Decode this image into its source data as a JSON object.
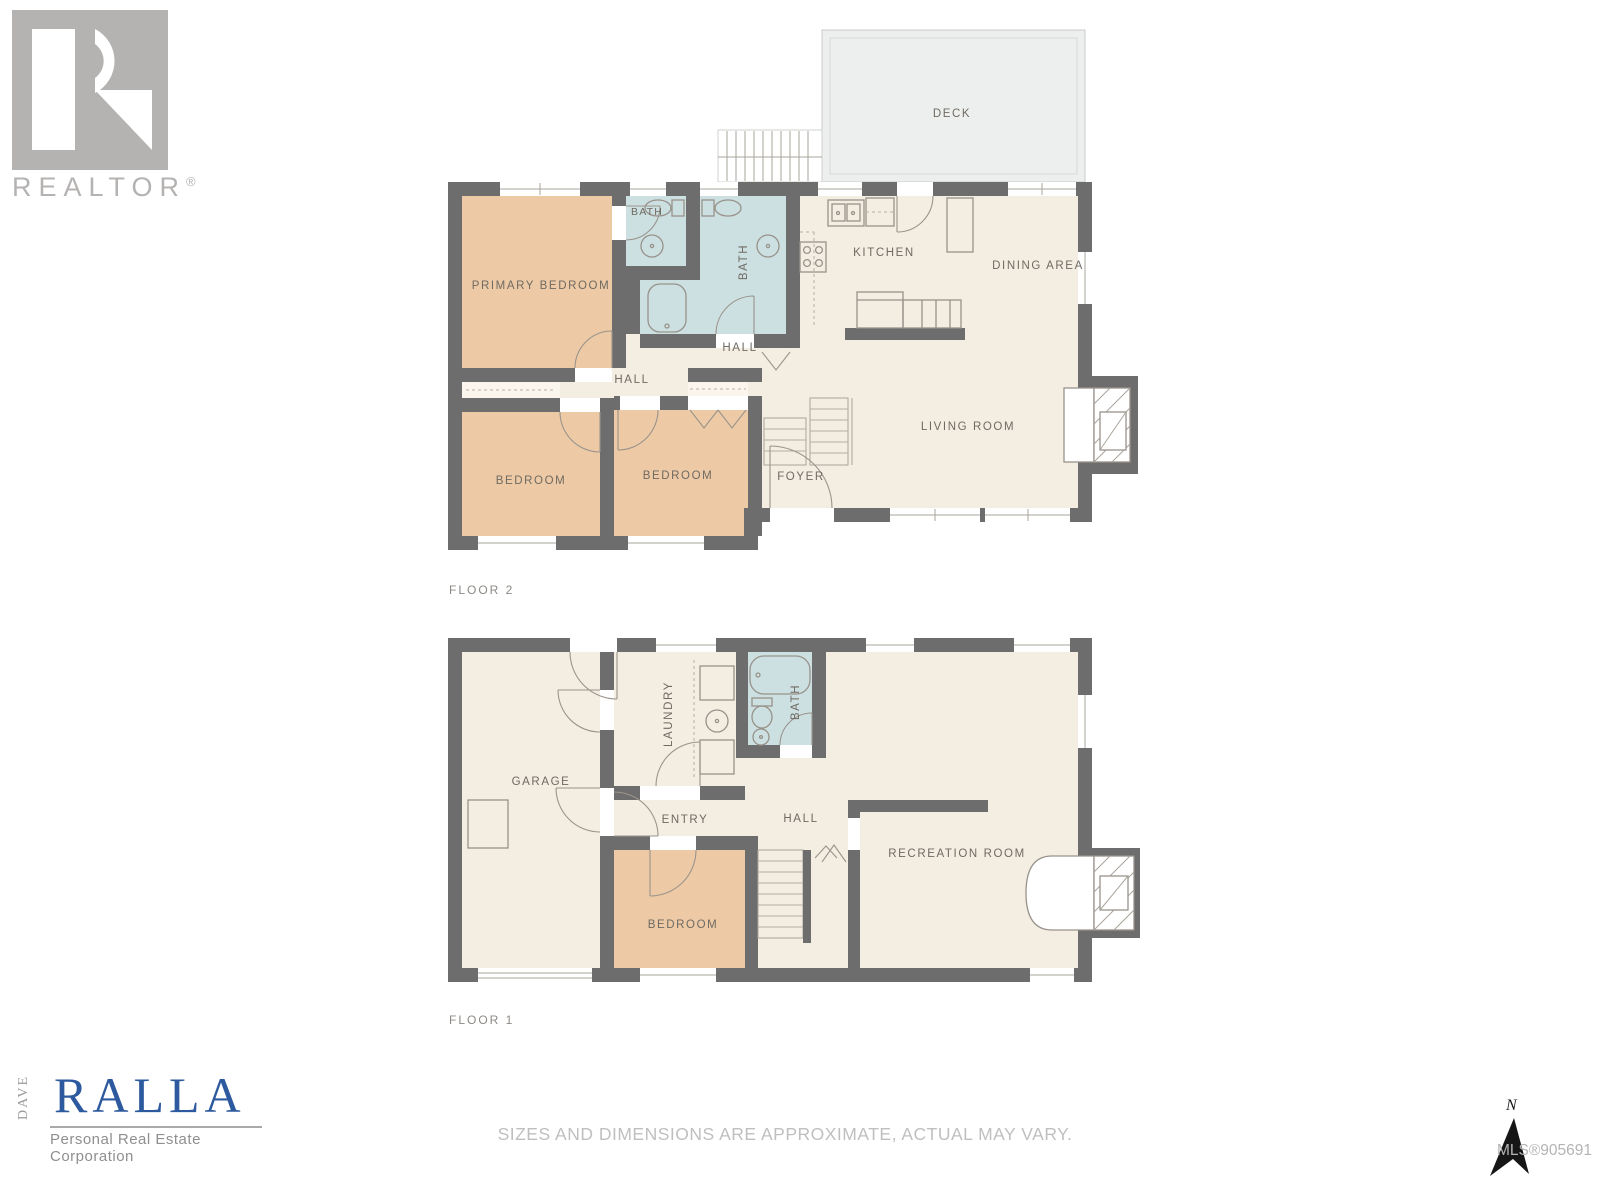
{
  "branding": {
    "realtor_wordmark": "REALTOR",
    "registered_symbol": "®",
    "agent": {
      "first_name": "DAVE",
      "last_name": "RALLA",
      "tagline": "Personal Real Estate Corporation"
    }
  },
  "colors": {
    "wall": "#6e6d6d",
    "floor": "#f4ede2",
    "bedroom_fill": "#edcaa5",
    "bath_fill": "#cde0e1",
    "deck_fill": "#edefef",
    "brand_blue": "#2d5a9e",
    "logo_gray": "#b5b3b2"
  },
  "floor2": {
    "label": "FLOOR 2",
    "deck": "DECK",
    "primary_bedroom": "PRIMARY BEDROOM",
    "bath_ensuite": "BATH",
    "bath_main": "BATH",
    "kitchen": "KITCHEN",
    "dining_area": "DINING AREA",
    "hall_upper": "HALL",
    "hall_lower": "HALL",
    "bedroom_left": "BEDROOM",
    "bedroom_middle": "BEDROOM",
    "foyer": "FOYER",
    "living_room": "LIVING ROOM"
  },
  "floor1": {
    "label": "FLOOR 1",
    "garage": "GARAGE",
    "laundry": "LAUNDRY",
    "bath": "BATH",
    "entry": "ENTRY",
    "hall": "HALL",
    "bedroom": "BEDROOM",
    "recreation_room": "RECREATION ROOM"
  },
  "footer": {
    "disclaimer": "SIZES AND DIMENSIONS ARE APPROXIMATE, ACTUAL MAY VARY.",
    "mls_number": "MLS®905691",
    "compass_label": "N"
  }
}
